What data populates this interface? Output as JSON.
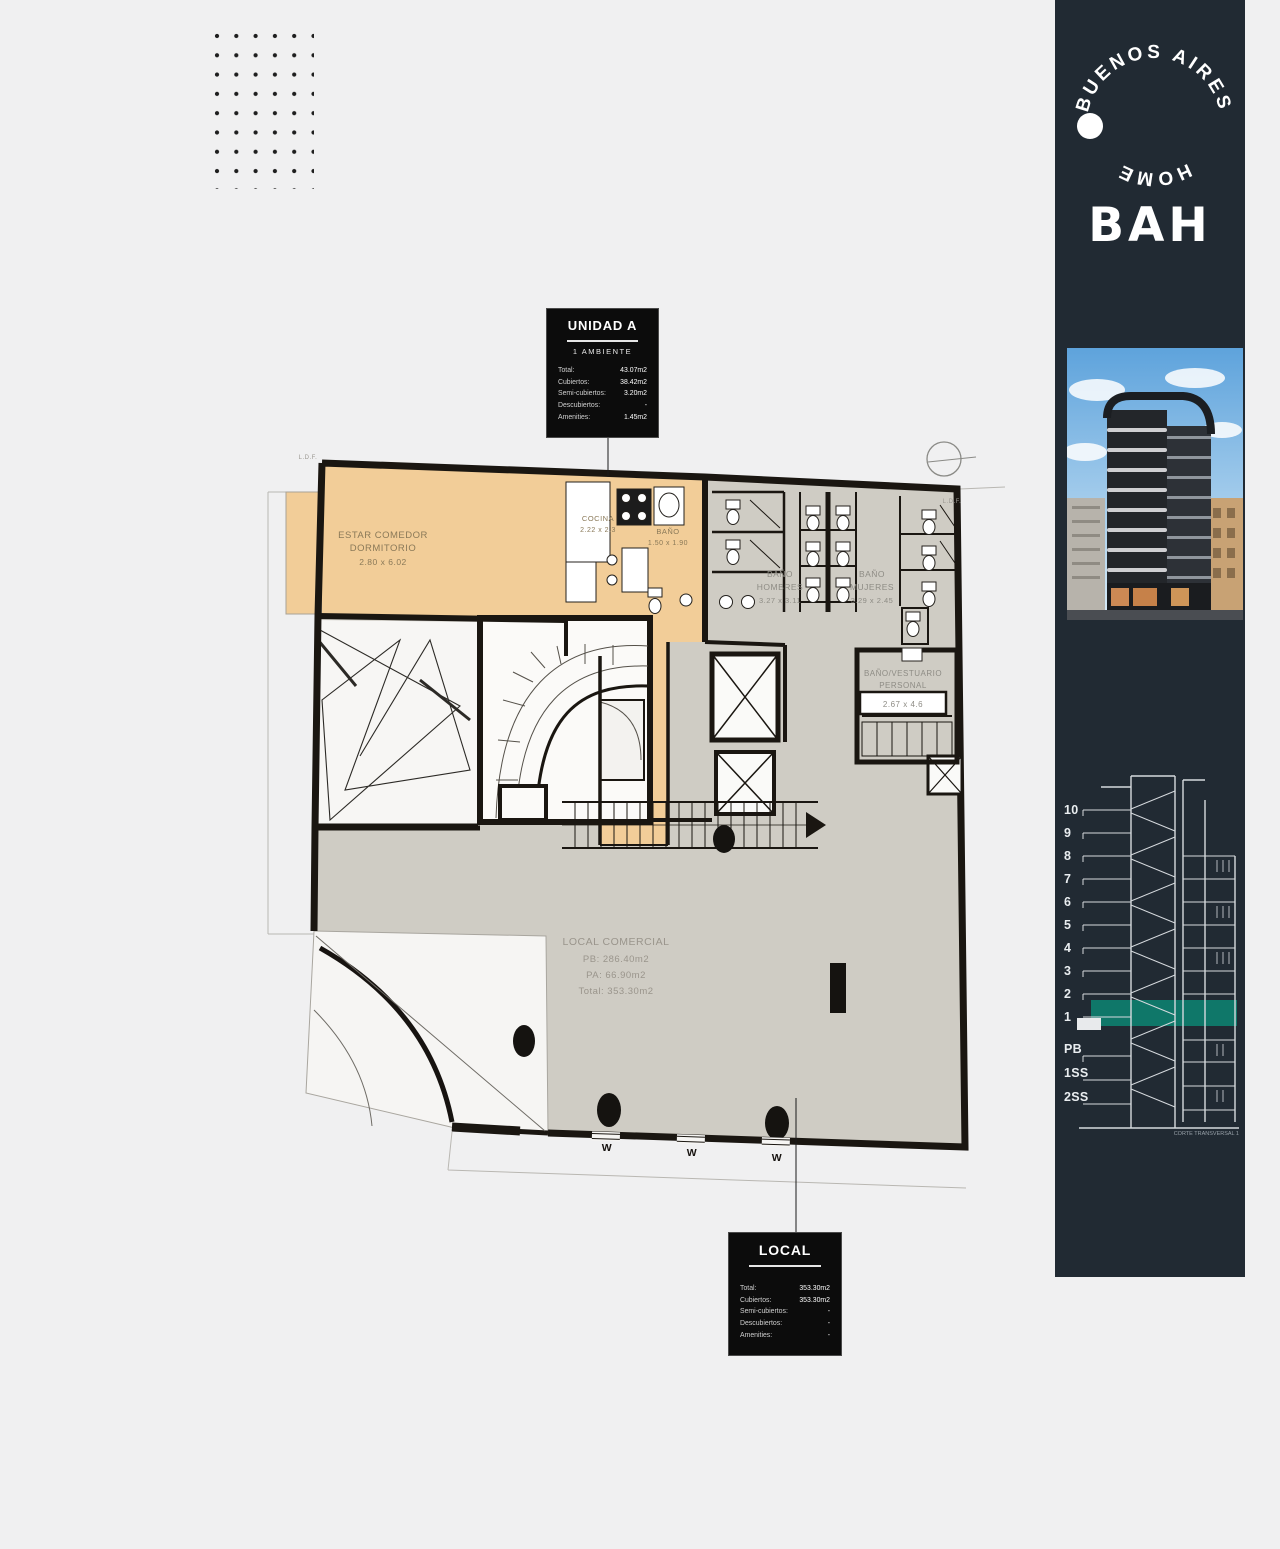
{
  "page": {
    "background": "#f0f0f1"
  },
  "plan": {
    "unit_fill": "#f2cd98",
    "common_fill": "#cfccc4",
    "corner_note": "L.D.F.",
    "window_mark": "W",
    "rooms": {
      "estar": {
        "line1": "ESTAR COMEDOR",
        "line2": "DORMITORIO",
        "dims": "2.80 x 6.02"
      },
      "cocina": {
        "line1": "COCINA",
        "dims": "2.22 x 2.3"
      },
      "bano": {
        "line1": "BAÑO",
        "dims": "1.50 x 1.90"
      },
      "hombres": {
        "line1": "BAÑO",
        "line2": "HOMBRES",
        "dims": "3.27 x 3.11"
      },
      "mujeres": {
        "line1": "BAÑO",
        "line2": "MUJERES",
        "dims": "3.29 x 2.45"
      },
      "vestuario": {
        "line1": "BAÑO/VESTUARIO",
        "line2": "PERSONAL",
        "dims": "2.67 x 4.6"
      },
      "local": {
        "line1": "LOCAL COMERCIAL",
        "line2": "PB: 286.40m2",
        "line3": "PA: 66.90m2",
        "line4": "Total: 353.30m2"
      }
    }
  },
  "cards": {
    "unidad_a": {
      "title": "UNIDAD A",
      "subtitle": "1 AMBIENTE",
      "stats": [
        {
          "label": "Total:",
          "value": "43.07m2"
        },
        {
          "label": "Cubiertos:",
          "value": "38.42m2"
        },
        {
          "label": "Semi-cubiertos:",
          "value": "3.20m2"
        },
        {
          "label": "Descubiertos:",
          "value": "-"
        },
        {
          "label": "Amenities:",
          "value": "1.45m2"
        }
      ]
    },
    "local": {
      "title": "LOCAL",
      "stats": [
        {
          "label": "Total:",
          "value": "353.30m2"
        },
        {
          "label": "Cubiertos:",
          "value": "353.30m2"
        },
        {
          "label": "Semi-cubiertos:",
          "value": "-"
        },
        {
          "label": "Descubiertos:",
          "value": "-"
        },
        {
          "label": "Amenities:",
          "value": "-"
        }
      ]
    }
  },
  "sidebar": {
    "panel_color": "#212a33",
    "logo": {
      "arc_top": "BUENOS AIRES",
      "arc_bottom": "HOME",
      "wordmark": "BAH"
    },
    "section": {
      "floors": [
        "10",
        "9",
        "8",
        "7",
        "6",
        "5",
        "4",
        "3",
        "2",
        "1",
        "PB",
        "1SS",
        "2SS"
      ],
      "highlighted_floor": "1",
      "highlight_color": "#0e7e6e",
      "caption": "CORTE TRANSVERSAL 1"
    }
  }
}
